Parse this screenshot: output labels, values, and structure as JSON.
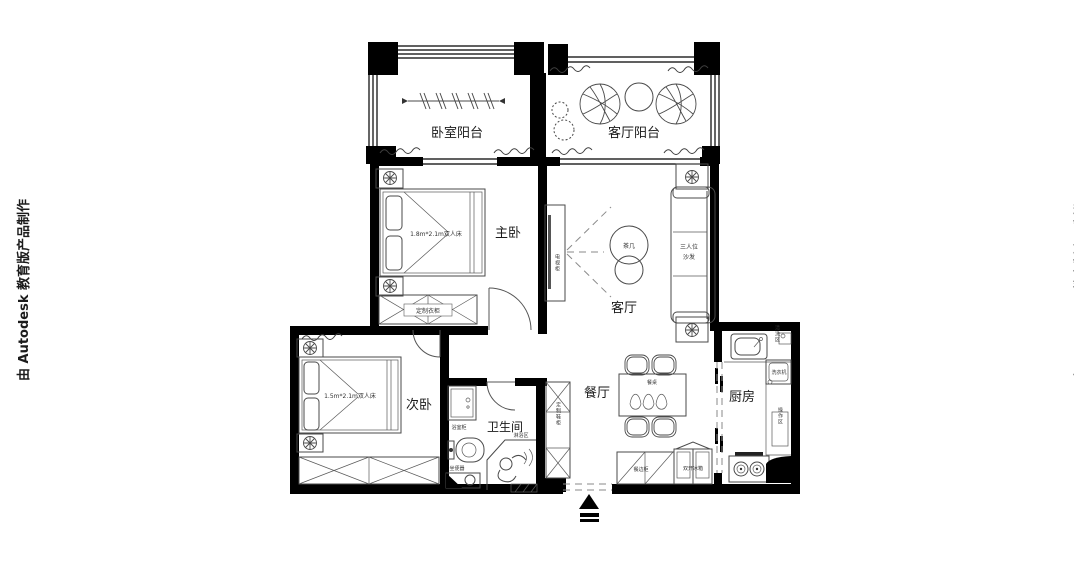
{
  "watermarks": {
    "left": "由 Autodesk 教育版产品制作",
    "right": "由 Autodesk 教育版产品制作"
  },
  "rooms": {
    "bedroom_balcony": "卧室阳台",
    "living_balcony": "客厅阳台",
    "master_bedroom": "主卧",
    "living_room": "客厅",
    "dining_room": "餐厅",
    "second_bedroom": "次卧",
    "bathroom": "卫生间",
    "kitchen": "厨房"
  },
  "furniture": {
    "master_bed": "1.8m*2.1m双人床",
    "master_wardrobe": "定制衣柜",
    "tv_cabinet": "电视柜",
    "tea_table": "茶几",
    "sofa_line1": "三人位",
    "sofa_line2": "沙发",
    "dining_table": "餐桌",
    "sideboard": "餐边柜",
    "fridge": "双开冰箱",
    "wash_zone": "清洗区",
    "washing_machine": "洗衣机",
    "work_zone": "操作区",
    "second_bed": "1.5m*2.1m双人床",
    "shoe_cabinet": "定制鞋柜",
    "vanity": "浴室柜",
    "toilet": "坐便器",
    "shower_zone": "淋浴区"
  },
  "colors": {
    "wall": "#000000",
    "line": "#4a4a4a",
    "background": "#ffffff"
  }
}
